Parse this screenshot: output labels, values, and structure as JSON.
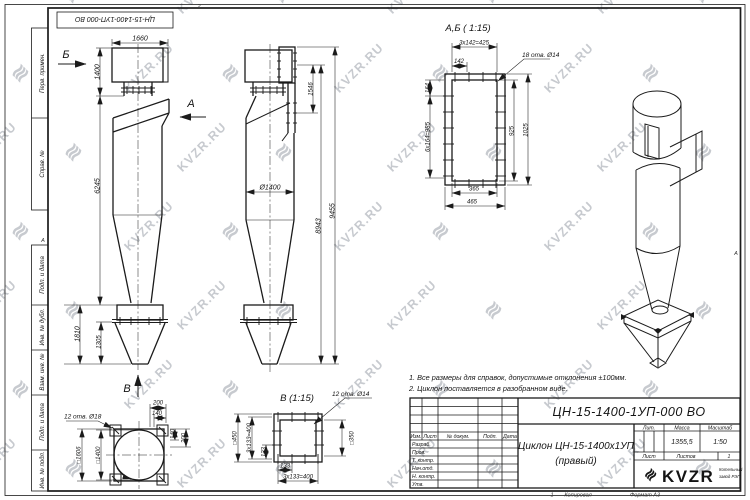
{
  "watermark": {
    "text": "KVZR.RU",
    "icon": "≋",
    "color": "#c7cacf"
  },
  "frame": {
    "doc_number_top": "ЦН-15-1400-1УП-000 ВО",
    "col_perv": "Перв. примен.",
    "col_sprav": "Справ. №",
    "col_podp1": "Подп. и дата",
    "col_inv_dubl": "Инв. № дубл.",
    "col_vzam": "Взам. инв. №",
    "col_podp2": "Подп. и дата",
    "col_inv_podl": "Инв. № подл.",
    "zone_top": "2",
    "zone_left": "А",
    "zone_right": "А",
    "zone_bottom": "1",
    "kopiroval": "Копировал",
    "format": "Формат А3"
  },
  "front_view": {
    "arrow_b": "Б",
    "arrow_a": "А",
    "arrow_v": "В",
    "dim_width": "1660",
    "dim_top": "1400",
    "dim_body": "6245",
    "dim_bin": "1810",
    "dim_bin_cone": "1305"
  },
  "side_view": {
    "dim_inlet": "1546",
    "dim_diam": "Ø1400",
    "dim_h2": "8943",
    "dim_total": "9455"
  },
  "section_ab": {
    "title": "А,Б ( 1:15)",
    "holes": "18 отв. Ø14",
    "dim_pitch_w": "3х142=425",
    "dim_142": "142",
    "dim_164": "164",
    "dim_pitch_h": "6х164=985",
    "dim_925": "925",
    "dim_1025": "1025",
    "dim_365": "365",
    "dim_465": "465"
  },
  "section_v": {
    "title": "В (1:15)",
    "holes": "12 отв. Ø14",
    "dim_sq450": "□450",
    "dim_pitch_v": "3х133=400",
    "dim_133v": "133",
    "dim_133h": "133",
    "dim_pitch_h": "3х133=400",
    "dim_sq350": "□350"
  },
  "top_view": {
    "holes": "12 отв. Ø18",
    "dim_200t": "200",
    "dim_140t": "140",
    "dim_140r": "140",
    "dim_200r": "200",
    "dim_sq1606": "□1606",
    "dim_sq1400": "□1400"
  },
  "notes": {
    "n1": "1. Все размеры для справок, допустимые отклонения ±100мм.",
    "n2": "2. Циклон поставляется в разобранном виде."
  },
  "title_block": {
    "doc_number": "ЦН-15-1400-1УП-000 ВО",
    "name_line1": "Циклон ЦН-15-1400х1УП",
    "name_line2": "(правый)",
    "lit_header": "Лит.",
    "mass_header": "Масса",
    "scale_header": "Масштаб",
    "mass_value": "1355,5",
    "scale_value": "1:50",
    "sheet_label": "Лист",
    "sheets_label": "Листов",
    "sheets_value": "1",
    "col_izm": "Изм.",
    "col_list": "Лист",
    "col_doc": "№ докум.",
    "col_podp": "Подп.",
    "col_data": "Дата",
    "row_razrab": "Разраб.",
    "row_prov": "Пров.",
    "row_tkontr": "Т. контр.",
    "row_nachotd": "Нач.отд.",
    "row_nkontr": "Н. контр.",
    "row_utv": "Утв.",
    "logo_icon": "≋",
    "logo_text": "KVZR",
    "logo_sub1": "Котельный",
    "logo_sub2": "завод РЭП"
  }
}
